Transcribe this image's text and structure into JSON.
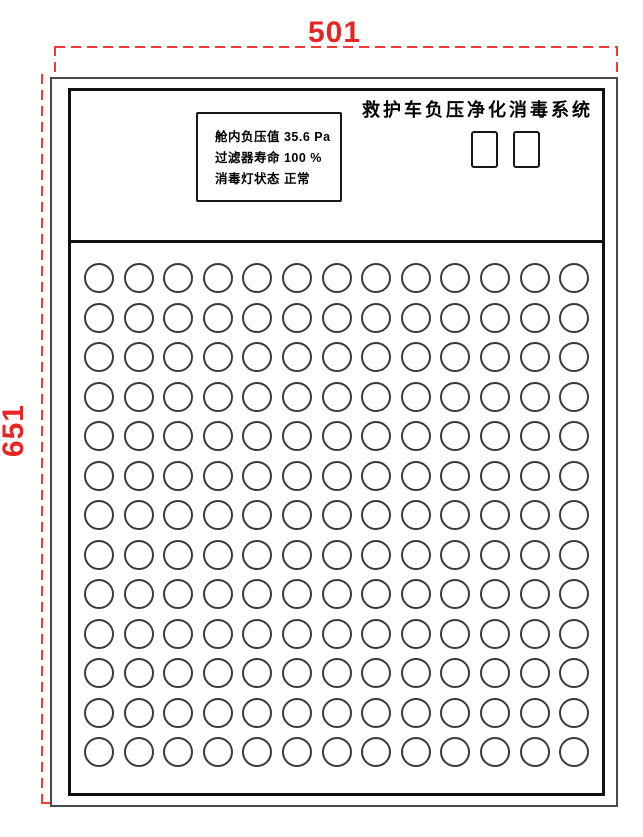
{
  "drawing": {
    "dimension_width_label": "501",
    "dimension_height_label": "651",
    "dimension_color": "#e62524"
  },
  "panel": {
    "title": "救护车负压净化消毒系统",
    "display": {
      "lines": [
        "舱内负压值 35.6 Pa",
        "过滤器寿命 100 %",
        "消毒灯状态 正常"
      ]
    },
    "buttons": [
      {
        "name": "panel-button-1"
      },
      {
        "name": "panel-button-2"
      }
    ],
    "hole_grid": {
      "rows": 13,
      "columns": 13
    }
  }
}
